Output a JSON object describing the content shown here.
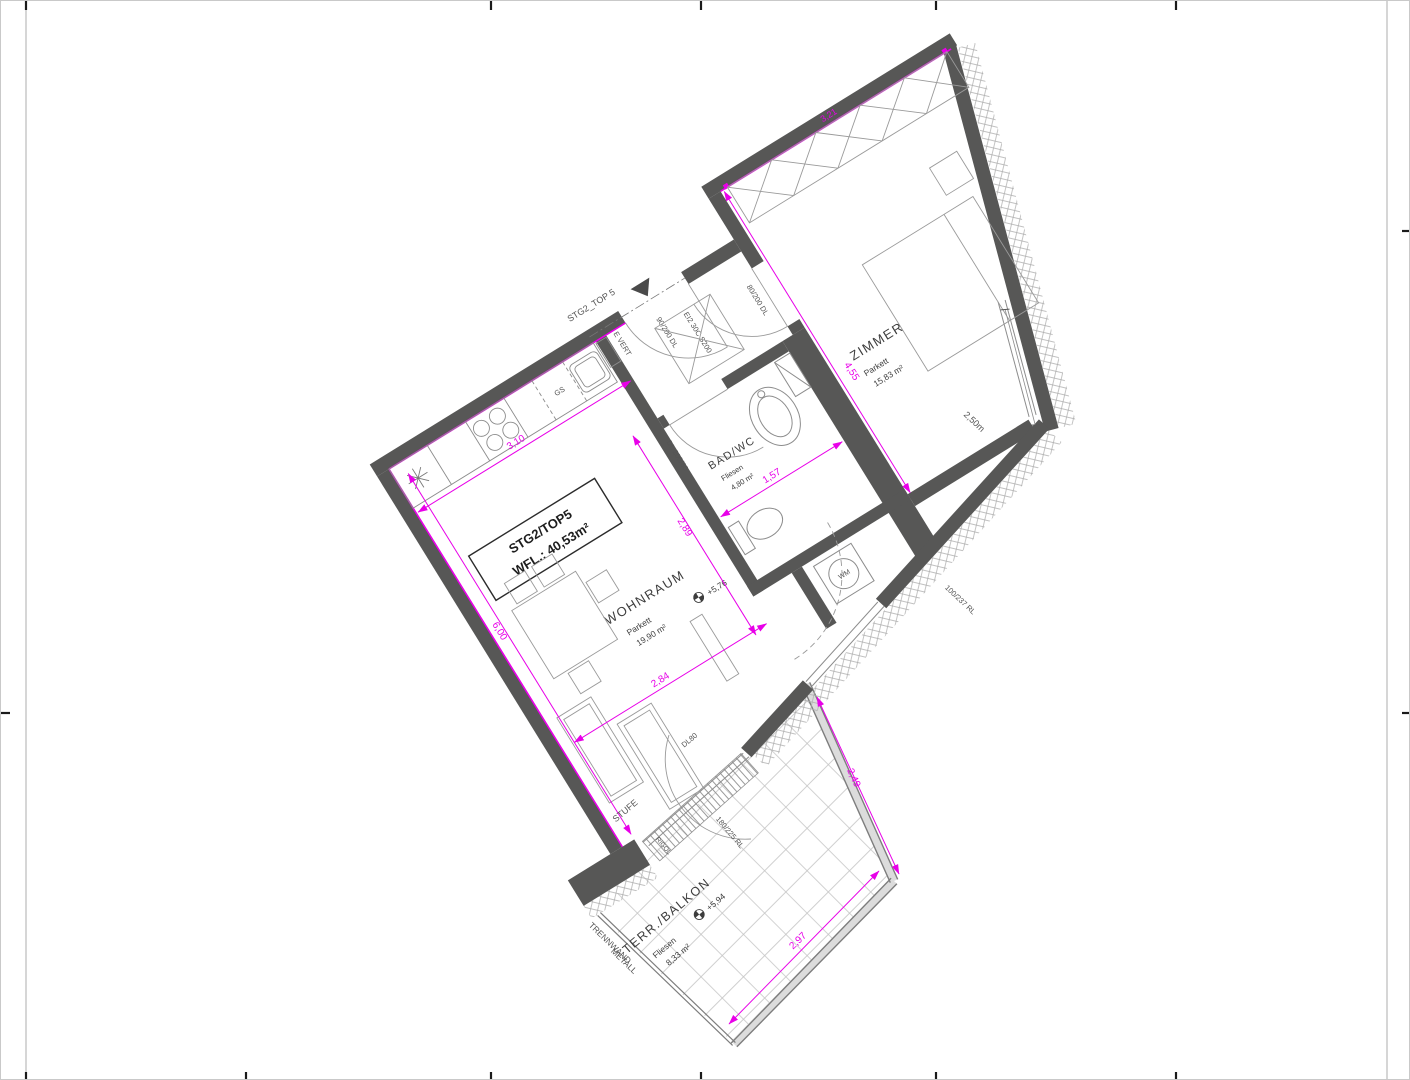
{
  "plan": {
    "title_box": {
      "line1": "STG2/TOP5",
      "line2": "WFL.: 40,53m²"
    },
    "entrance": {
      "label": "STG2_TOP 5",
      "door_label": "90/200 DL",
      "fire_label": "EI2 30C S200",
      "shaft_label": "E VERT"
    },
    "rooms": {
      "wohnraum": {
        "name": "WOHNRAUM",
        "floor": "Parkett",
        "area": "19,90 m²",
        "level": "+5,76"
      },
      "zimmer": {
        "name": "ZIMMER",
        "floor": "Parkett",
        "area": "15,83 m²",
        "door_label": "80/200 DL"
      },
      "bad": {
        "name": "BAD/WC",
        "floor": "Fliesen",
        "area": "4,80 m²",
        "door_label": "DL 200/80",
        "wm_label": "WM"
      },
      "terrasse": {
        "name": "TERR./BALKON",
        "floor": "Fliesen",
        "area": "8,33 m²",
        "level": "+5,94",
        "door_label": "DL80",
        "step_label": "STUFE",
        "drain_label": "RIGOL",
        "partition_line1": "TRENNWAND",
        "partition_line2": "METALL",
        "window_label": "180/225 RL"
      }
    },
    "kitchen": {
      "dishwasher_label": "GS"
    },
    "windows": {
      "w_side": "100/237 RL",
      "w_zimmer": "2,50m"
    },
    "dimensions": {
      "d310": "3,10",
      "d600": "6,00",
      "d284": "2,84",
      "d157": "1,57",
      "d289": "2,89",
      "d455": "4,55",
      "d321": "3,21",
      "d249": "2,49",
      "d297": "2,97"
    },
    "colors": {
      "wall": "#575756",
      "dim": "#e800e8"
    }
  }
}
